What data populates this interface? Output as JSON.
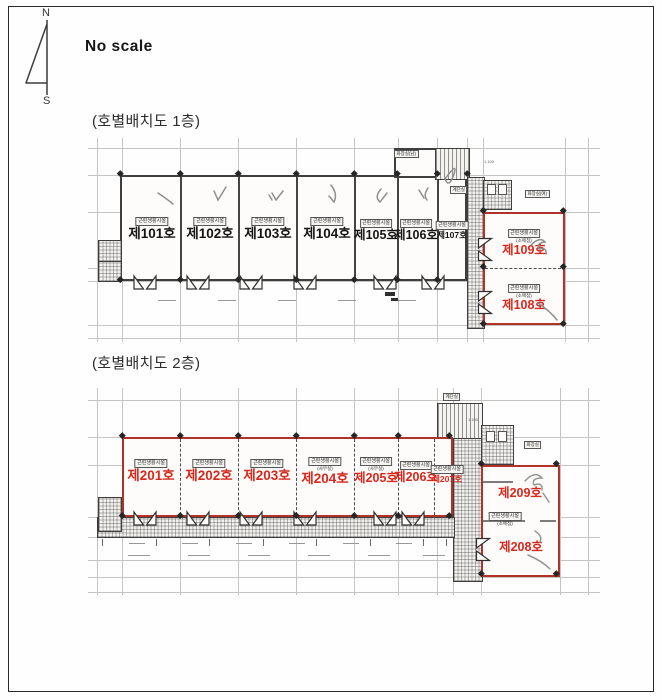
{
  "page": {
    "no_scale": "No scale",
    "compass": {
      "n": "N",
      "s": "S"
    }
  },
  "floor1": {
    "title": "(호별배치도 1층)",
    "units": [
      {
        "type": "근린생활시설",
        "number": "제101호"
      },
      {
        "type": "근린생활시설",
        "number": "제102호"
      },
      {
        "type": "근린생활시설",
        "number": "제103호"
      },
      {
        "type": "근린생활시설",
        "number": "제104호"
      },
      {
        "type": "근린생활시설",
        "number": "제105호"
      },
      {
        "type": "근린생활시설",
        "number": "제106호"
      },
      {
        "type": "근린생활시설",
        "number": "제107호"
      }
    ],
    "right_units": [
      {
        "type": "근린생활시설",
        "sub": "(소매점)",
        "number": "제109호"
      },
      {
        "type": "근린생활시설",
        "sub": "(소매점)",
        "number": "제108호"
      }
    ],
    "rooms": {
      "toilet_m": "화장실(남)",
      "stair": "계단실",
      "toilet_f": "화장실(여)",
      "dim": "1,100"
    }
  },
  "floor2": {
    "title": "(호별배치도 2층)",
    "units": [
      {
        "type": "근린생활시설",
        "number": "제201호"
      },
      {
        "type": "근린생활시설",
        "number": "제202호"
      },
      {
        "type": "근린생활시설",
        "number": "제203호"
      },
      {
        "type": "근린생활시설",
        "sub": "(사무실)",
        "number": "제204호"
      },
      {
        "type": "근린생활시설",
        "sub": "(사무실)",
        "number": "제205호"
      },
      {
        "type": "근린생활시설",
        "number": "제206호"
      },
      {
        "type": "근린생활시설",
        "number": "제207호"
      }
    ],
    "right_units": [
      {
        "number": "제209호"
      },
      {
        "type": "근린생활시설",
        "sub": "(소매점)",
        "number": "제208호"
      }
    ],
    "rooms": {
      "stair": "계단실",
      "toilet": "화장실",
      "dim": "1,100"
    }
  }
}
